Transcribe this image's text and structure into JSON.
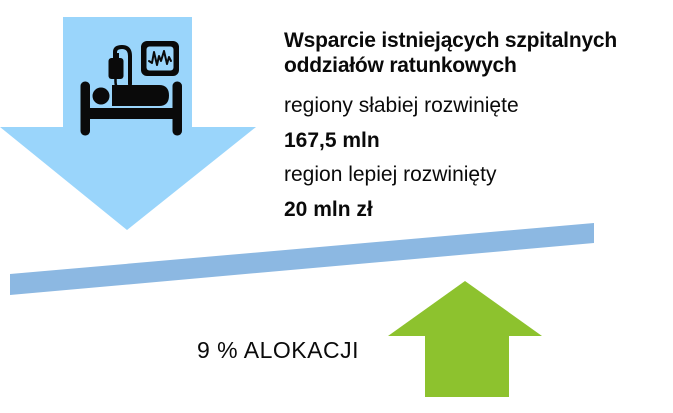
{
  "colors": {
    "down_arrow": "#9AD5FB",
    "beam": "#8CB8E2",
    "up_arrow": "#8DC22E",
    "icon_ink": "#0A0A0A",
    "text_ink": "#0A0A0A",
    "background": "#FFFFFF"
  },
  "content": {
    "title_lines": {
      "0": "Wsparcie istniejących szpitalnych",
      "1": "oddziałów ratunkowych"
    },
    "rows": [
      {
        "label": "regiony słabiej rozwinięte"
      },
      {
        "label": "167,5 mln"
      },
      {
        "label": "region lepiej rozwinięty"
      },
      {
        "label": "20 mln zł"
      }
    ],
    "allocation_label": "9 % ALOKACJI"
  },
  "icons": {
    "down_arrow": "big-down-arrow",
    "up_arrow": "big-up-arrow",
    "beam": "tilted-balance-beam",
    "hospital_bed": "hospital-bed-with-patient-iv-drip-and-ecg-monitor"
  }
}
